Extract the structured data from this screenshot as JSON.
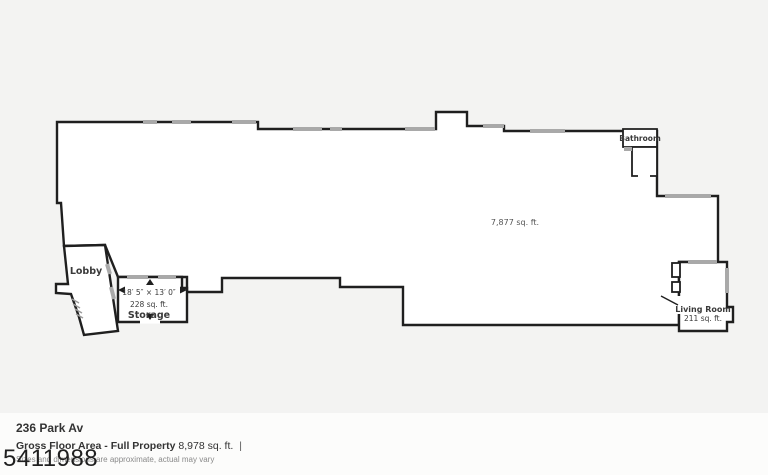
{
  "colors": {
    "wall": "#1f1f1f",
    "window": "#a9a9a9",
    "bg": "#f3f3f2",
    "floor": "#ffffff",
    "info_bg": "#fcfcfb",
    "text": "#333333",
    "muted": "#8a8a8a",
    "watermark": "#1f1f1f"
  },
  "floor_plan": {
    "main_area_sqft": "7,877 sq. ft.",
    "rooms": {
      "bathroom": {
        "label": "Bathroom"
      },
      "lobby": {
        "label": "Lobby"
      },
      "storage": {
        "label": "Storage",
        "dimensions": "18′ 5″ × 13′ 0″",
        "area": "228 sq. ft."
      },
      "living_room": {
        "label": "Living Room",
        "area": "211 sq. ft."
      }
    }
  },
  "info": {
    "address": "236 Park Av",
    "gross_floor_label": "Gross Floor Area - Full Property",
    "gross_floor_value": "8,978 sq. ft.",
    "separator": "|",
    "disclaimer": "Sizes and dimensions are approximate, actual may vary"
  },
  "watermark": "5411988"
}
